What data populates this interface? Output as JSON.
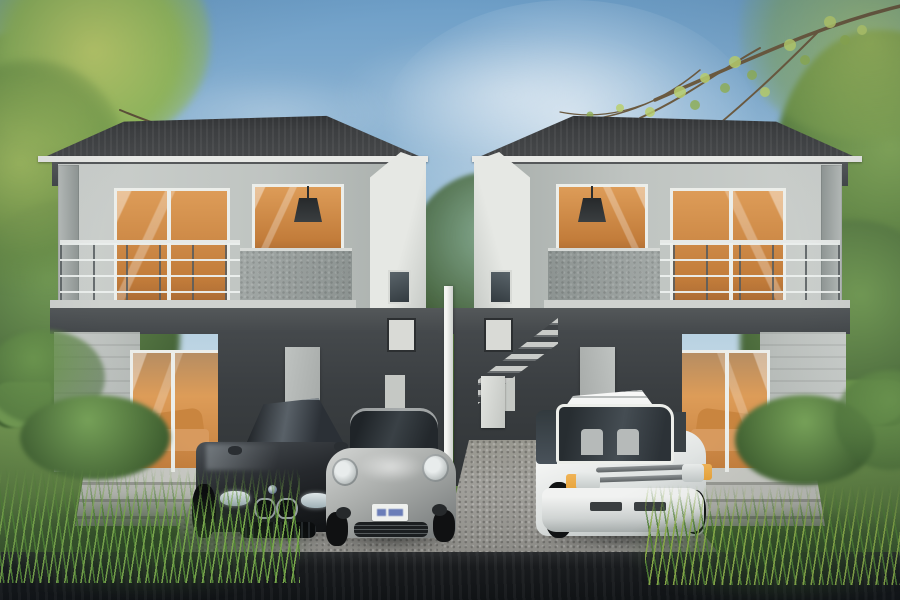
{
  "scene": {
    "description": "Photorealistic 3D architectural rendering of two identical modern two-storey houses shown side by side under a blue sky, with an exterior staircase in the gap between them, three cars parked on gravel driveways in front, and landscaped gardens all around",
    "objects": [
      "blue sky with soft clouds and bright haze",
      "overhanging tree branches with sparse yellow-green leaves in both top corners",
      "dense green trees flanking the left and right edges",
      "left house: dark grey hip roof with white fascia, recessed balcony with cable railing and speckled concrete parapet",
      "right house: mirror image of the left house",
      "floor-to-ceiling glazed doors glowing warm orange from interior lighting",
      "dark pendant lamp visible inside each upper-floor window",
      "recessed soffit downlights under the roof overhang",
      "dark charcoal carport walls with light utility doors and small windows",
      "exterior concrete staircase rising between the two houses",
      "white corner post at the centre of the driveway split",
      "ground-floor glass doors reflecting an orange sofa",
      "stone entry steps in front of each house",
      "dark saloon car with twin-kidney grille parked facing the viewer",
      "silver sports car with round headlights and a white licence plate with illegible blue characters",
      "white minivan with amber corner indicators parked at the right house",
      "gravel driveways, green lawns, clipped hedges and ornamental tall grasses",
      "dark asphalt road strip across the bottom foreground"
    ],
    "house_count": 2,
    "car_count": 3,
    "cars": [
      {
        "name": "dark-saloon",
        "body_color": "#202326",
        "position": "front of left house"
      },
      {
        "name": "silver-sports-car",
        "body_color": "#b5b8b6",
        "position": "front of left house, right of saloon"
      },
      {
        "name": "white-minivan",
        "body_color": "#f0f2f0",
        "position": "front of right house"
      }
    ],
    "time_of_day": "daytime",
    "style": "architectural visualization"
  },
  "colors": {
    "sky_top": "#6d9ec7",
    "sky_mid": "#a7c6db",
    "sky_low": "#d3e3ec",
    "cloud": "#ffffff",
    "foliage_dark": "#3c5832",
    "foliage_mid": "#5d8244",
    "foliage_light": "#86ab5c",
    "leaf_yellow": "#b9c96a",
    "branch_brown": "#6b5a40",
    "lawn_light": "#84a55c",
    "lawn_mid": "#5f8143",
    "lawn_dark": "#3e5c2f",
    "hedge": "#587e41",
    "grass_bright": "#7fae4e",
    "grass_deep": "#2e4a24",
    "roof_dark": "#47494b",
    "roof_edge": "#2f3133",
    "fascia": "#e8e9e6",
    "soffit": "#4b4e50",
    "wall_light": "#ccd0cd",
    "wall_mid": "#a9afac",
    "wall_white": "#e3e5e1",
    "concrete": "#9aa09e",
    "charcoal": "#3a3e41",
    "charcoal_dark": "#303436",
    "slab_light": "#cfd2cf",
    "glass_orange": "#dd9c58",
    "glass_orange_deep": "#c27c3a",
    "interior_dark": "#9c6130",
    "glass_sky": "#b7ccd6",
    "frame_white": "#eceeea",
    "railing_light": "#e6e9e7",
    "railing_dark": "#565c5f",
    "step_light": "#c4c5bf",
    "step_dark": "#94958f",
    "gravel": "#a09f9a",
    "gravel_dark": "#868580",
    "stone": "#b5b6b0",
    "asphalt": "#191b1d",
    "asphalt_light": "#2a2c2e",
    "car_black": "#202326",
    "car_black_hi": "#565c61",
    "car_silver": "#b5b8b6",
    "car_silver_dark": "#7e8282",
    "van_white": "#f0f2f0",
    "van_shade": "#c7cbca",
    "glass_tint": "#343a3f",
    "amber": "#e7a33b",
    "plate_white": "#eef0ee",
    "plate_blue": "#3f57a6"
  }
}
